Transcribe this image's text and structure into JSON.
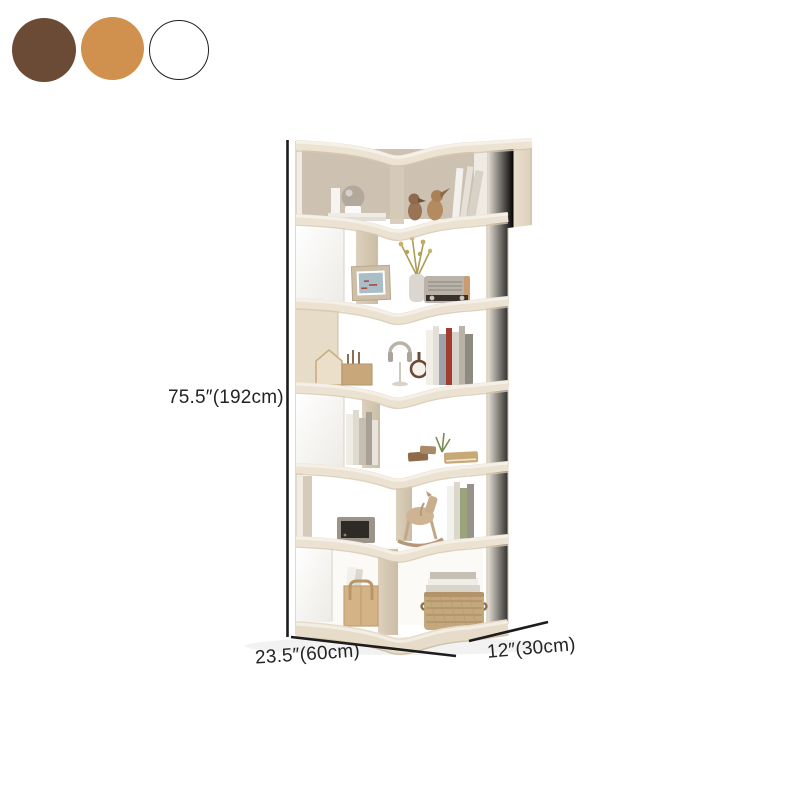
{
  "product": {
    "type": "corner-bookshelf",
    "tiers": 6
  },
  "swatches": [
    {
      "label": "brown",
      "color": "#6b4a36"
    },
    {
      "label": "oak",
      "color": "#d0914f"
    },
    {
      "label": "white",
      "color": "#ffffff"
    }
  ],
  "dimensions": {
    "height": "75.5″(192cm)",
    "width": "23.5″(60cm)",
    "depth": "12″(30cm)"
  },
  "style_colors": {
    "shelf_cream": "#ebe2d2",
    "shelf_white_panel": "#fbfaf8",
    "dimension_line": "#1c1c1c",
    "background": "#ffffff"
  }
}
